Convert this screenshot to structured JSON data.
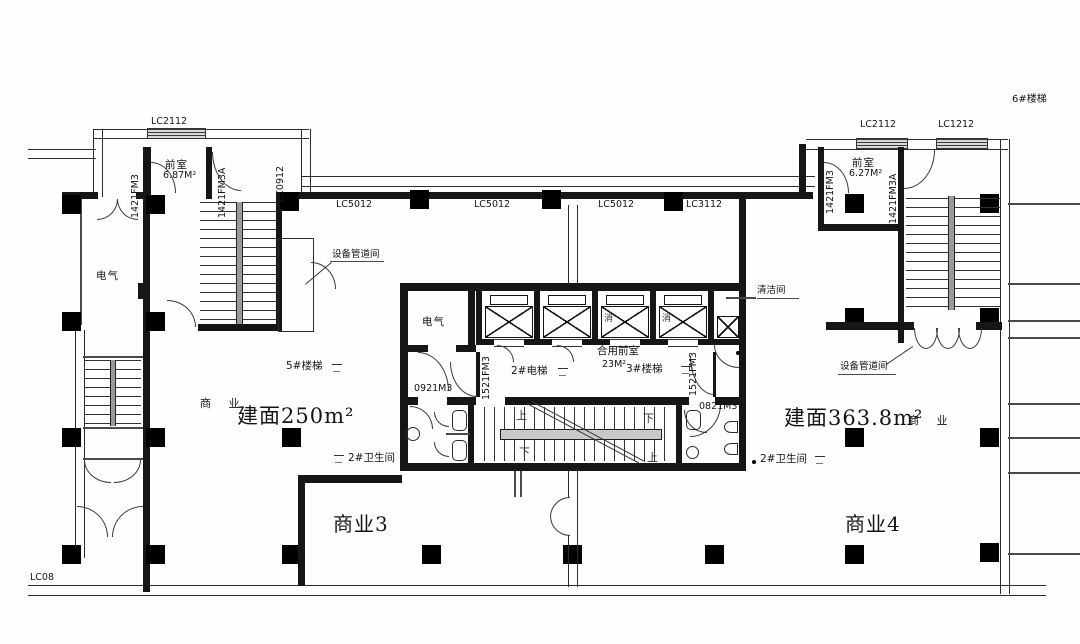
{
  "colors": {
    "line": "#161616",
    "background": "#fefefe"
  },
  "labels": {
    "lc2112": "LC2112",
    "lc1212": "LC1212",
    "lc0912": "LC0912",
    "lc5012": "LC5012",
    "lc3112": "LC3112",
    "lc08": "LC08",
    "fm1421": "1421FM3",
    "fm1421a": "1421FM3A",
    "fm1521": "1521FM3",
    "m0921": "0921M3",
    "m0821": "0821M3",
    "anteroom": "前室",
    "area_687": "6.87M²",
    "area_627": "6.27M²",
    "electrical": "电气",
    "equip_duct": "设备管道间",
    "cleaning": "清洁间",
    "shared_lobby": "合用前室",
    "area_23": "23M²",
    "stair3": "3#楼梯",
    "stair5": "5#楼梯",
    "stair6": "6#楼梯",
    "elev2": "2#电梯",
    "toilet2": "2#卫生间",
    "commercial": "商 业",
    "area_250": "建面250m²",
    "area_3638": "建面363.8m²",
    "shop3": "商业3",
    "shop4": "商业4",
    "up": "上",
    "down": "下",
    "fire": "消"
  }
}
